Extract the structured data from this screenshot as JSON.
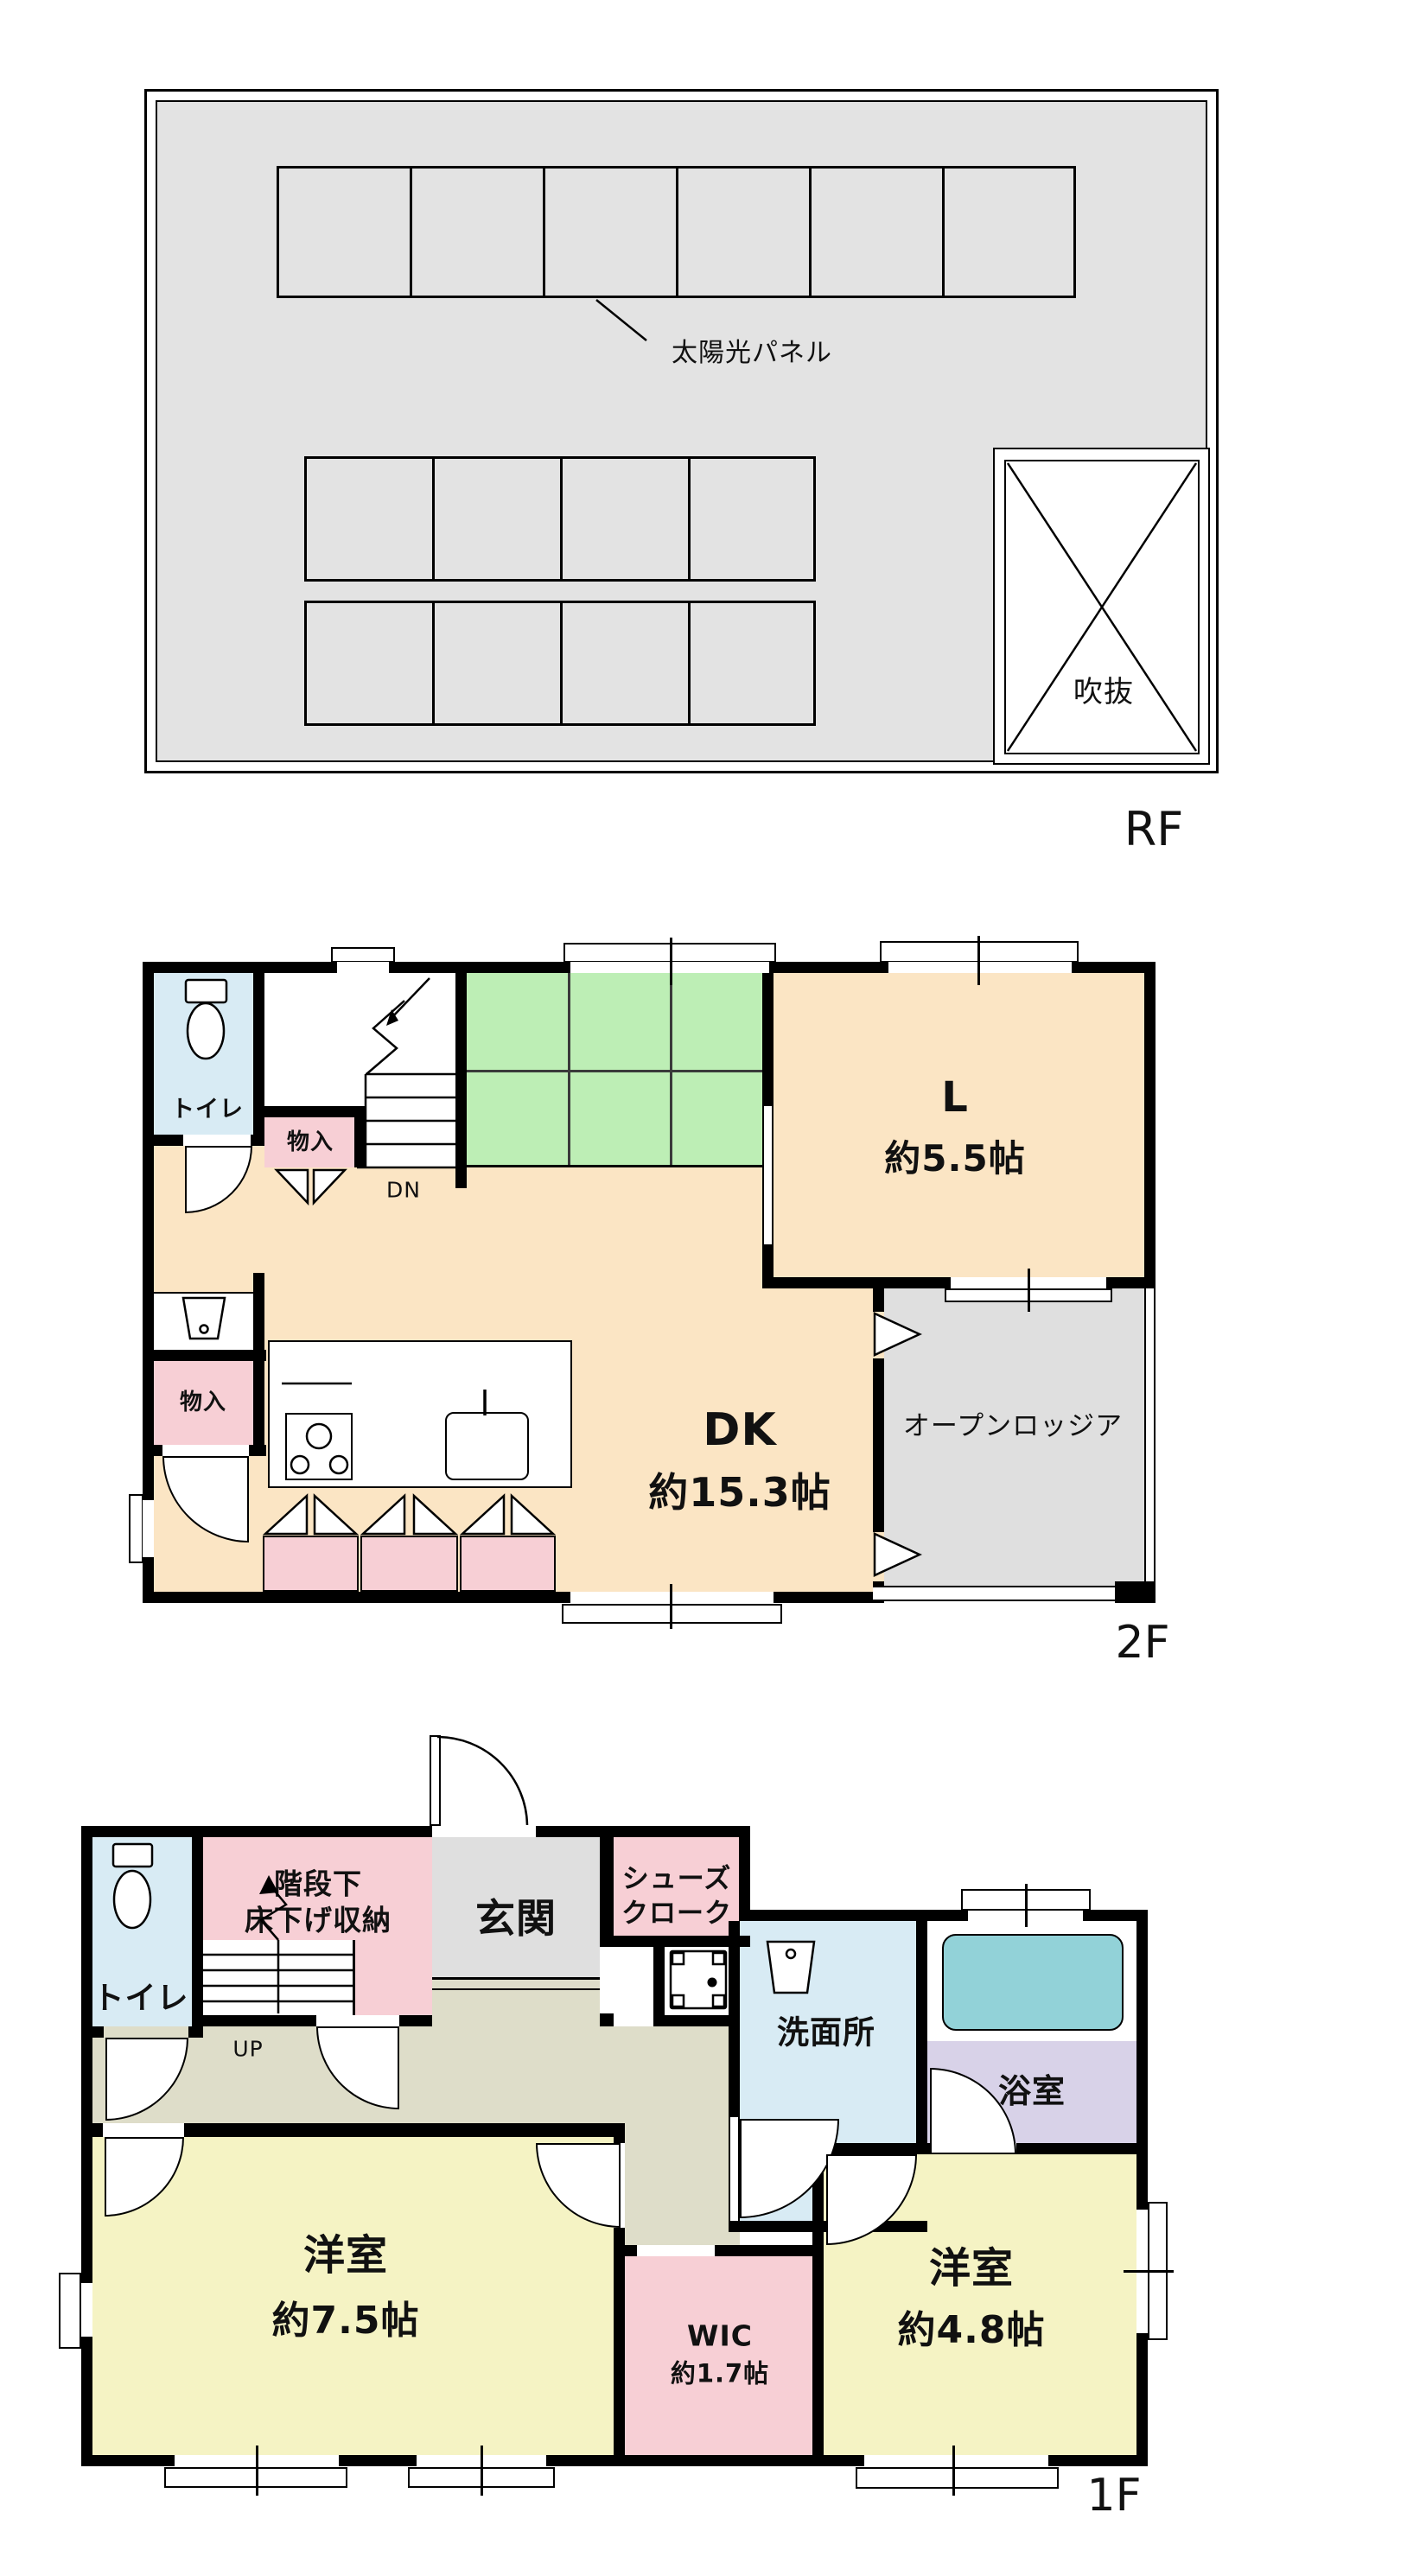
{
  "document_type": "floor-plan",
  "rf": {
    "floor_label": "RF",
    "solar_panel": "太陽光パネル",
    "void_label": "吹抜"
  },
  "f2": {
    "floor_label": "2F",
    "toilet": "トイレ",
    "storage_upper": "物入",
    "storage_lower": "物入",
    "stairs_down": "DN",
    "living_name": "L",
    "living_area": "約5.5帖",
    "dk_name": "DK",
    "dk_area": "約15.3帖",
    "loggia": "オープンロッジア"
  },
  "f1": {
    "floor_label": "1F",
    "toilet": "トイレ",
    "under_stair_storage_line1": "階段下",
    "under_stair_storage_line2": "床下げ収納",
    "stairs_up": "UP",
    "entrance": "玄関",
    "shoe_closet_line1": "シューズ",
    "shoe_closet_line2": "クローク",
    "washroom": "洗面所",
    "bathroom": "浴室",
    "bedroom_a_name": "洋室",
    "bedroom_a_area": "約7.5帖",
    "wic_name": "WIC",
    "wic_area": "約1.7帖",
    "bedroom_b_name": "洋室",
    "bedroom_b_area": "約4.8帖"
  },
  "colors": {
    "wall": "#000000",
    "roof_gray": "#e3e3e3",
    "beige_dk": "#fbe5c4",
    "light_blue": "#d8ebf4",
    "pink_storage": "#f7cfd5",
    "green_tatami": "#bdeeb5",
    "gray_loggia_genkan": "#dfdfdf",
    "sage_hall": "#deddc9",
    "yellow_bedroom": "#f5f3c4",
    "purple_bath": "#d8d2e8",
    "teal_tub": "#92d2d8"
  }
}
